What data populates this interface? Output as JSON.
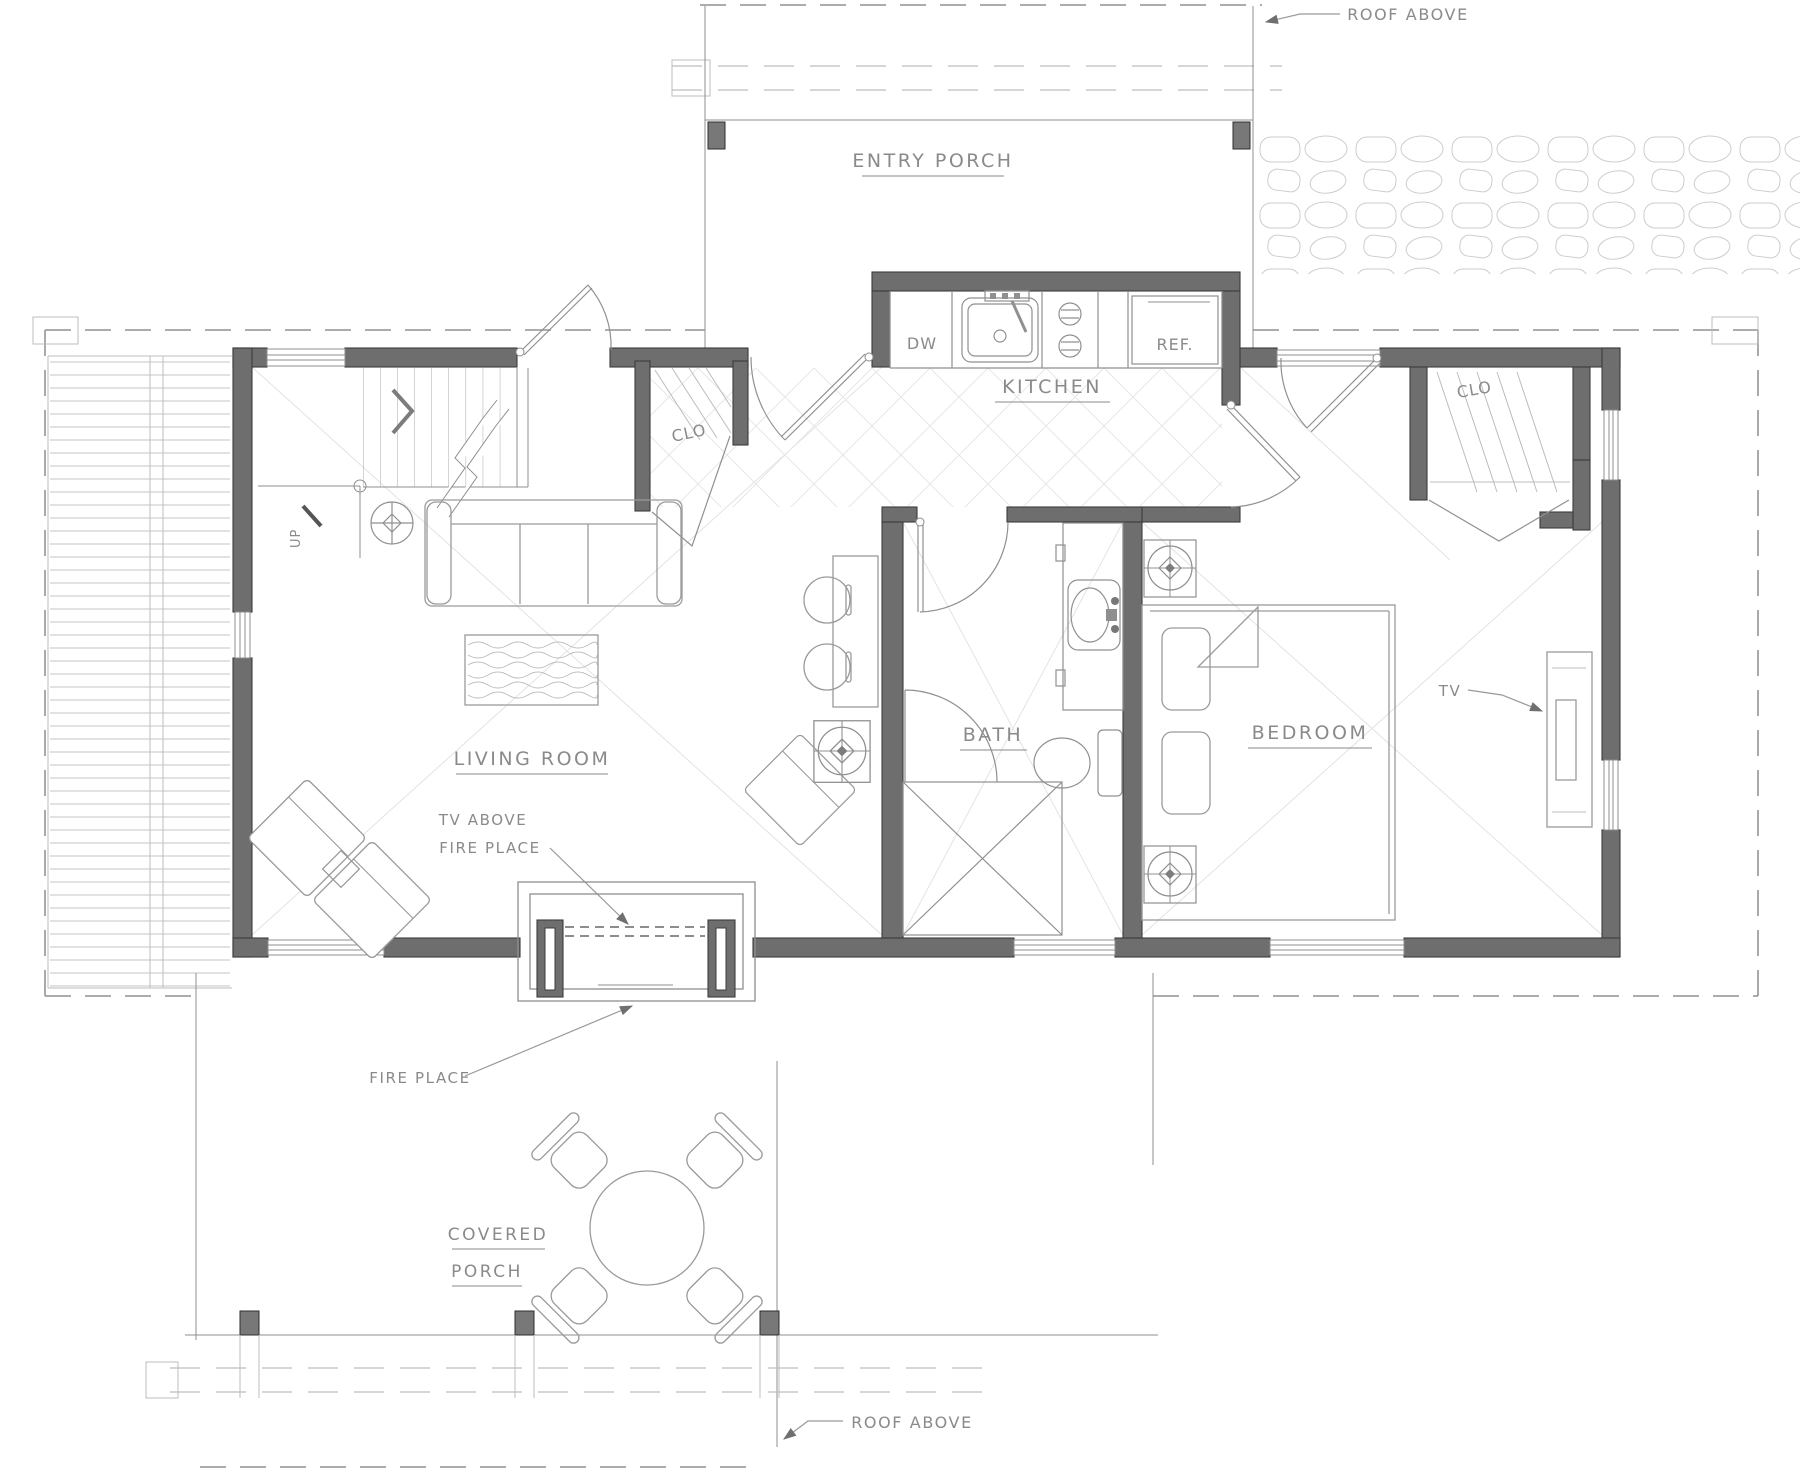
{
  "labels": {
    "roof_above_top": "ROOF ABOVE",
    "roof_above_bottom": "ROOF ABOVE",
    "entry_porch": "ENTRY PORCH",
    "kitchen": "KITCHEN",
    "dishwasher": "DW",
    "refrigerator": "REF.",
    "closet_entry": "CLO",
    "closet_bedroom": "CLO",
    "up": "UP",
    "living_room": "LIVING ROOM",
    "tv_above_line1": "TV ABOVE",
    "tv_above_line2": "FIRE PLACE",
    "bath": "BATH",
    "bedroom": "BEDROOM",
    "tv": "TV",
    "fire_place": "FIRE PLACE",
    "covered_porch_line1": "COVERED",
    "covered_porch_line2": "PORCH"
  },
  "colors": {
    "wall": "#6e6e6e",
    "wall_stroke": "#3c3c3c",
    "line": "#8f8f8f",
    "light": "#bdbdbd",
    "faint": "#e3e3e3",
    "dash": "#a0a0a0",
    "text": "#8a8a8a",
    "background": "#ffffff"
  }
}
